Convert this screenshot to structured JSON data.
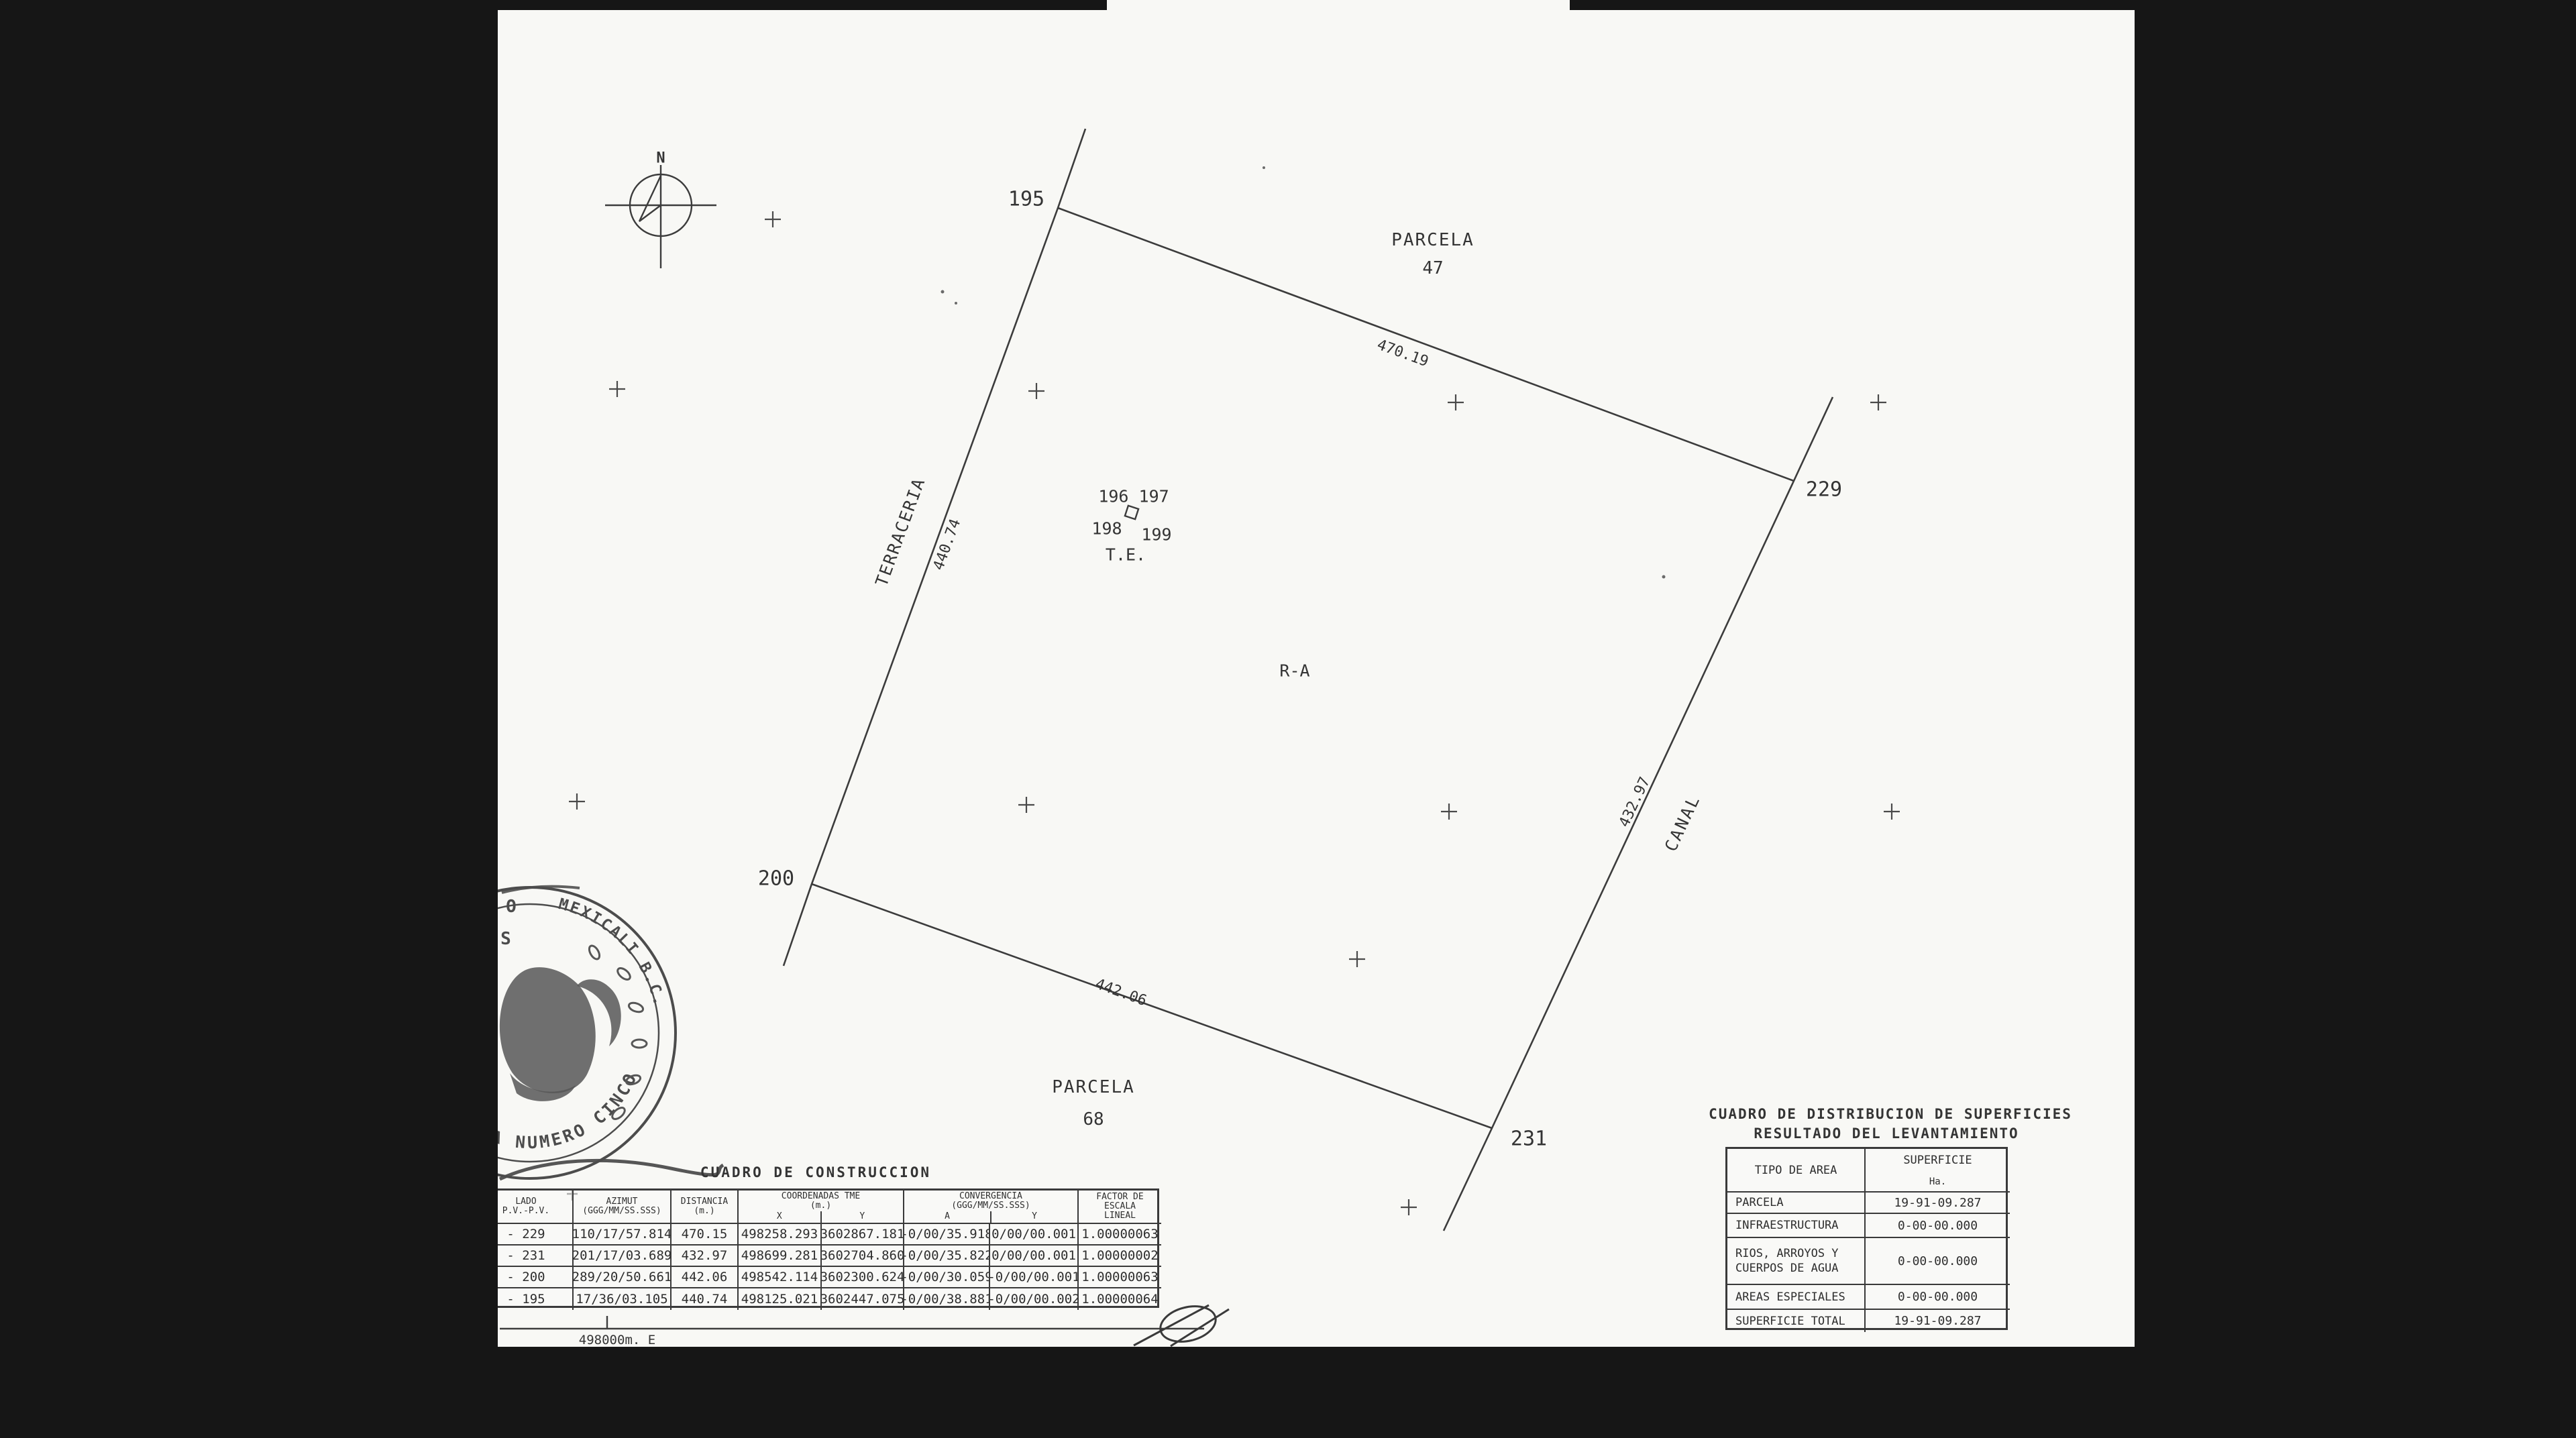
{
  "colors": {
    "paper": "#f8f8f5",
    "ink": "#2e2e2e",
    "bar": "#161616"
  },
  "map": {
    "north_label": "N",
    "vertices": {
      "v195": "195",
      "v229": "229",
      "v231": "231",
      "v200": "200"
    },
    "parcel_top": {
      "word": "PARCELA",
      "number": "47"
    },
    "parcel_bottom": {
      "word": "PARCELA",
      "number": "68"
    },
    "interior": {
      "points_row1": "196 197",
      "point_198": "198",
      "point_199": "199",
      "te": "T.E.",
      "ra": "R-A"
    },
    "edges": {
      "top_length": "470.19",
      "bottom_length": "442.06",
      "left_length": "440.74",
      "right_length": "432.97",
      "left_name": "TERRACERIA",
      "right_name": "CANAL"
    },
    "grid_label": "498000m. E"
  },
  "construction_table": {
    "title": "CUADRO DE CONSTRUCCION",
    "headers": {
      "lado": "LADO",
      "pv": "P.V.-P.V.",
      "azimut": "AZIMUT",
      "azimut_unit": "(GGG/MM/SS.SSS)",
      "distancia": "DISTANCIA",
      "distancia_unit": "(m.)",
      "coordenadas": "COORDENADAS TME",
      "coordenadas_unit": "(m.)",
      "x": "X",
      "y": "Y",
      "convergencia": "CONVERGENCIA",
      "convergencia_unit": "(GGG/MM/SS.SSS)",
      "conv_a": "A",
      "conv_y": "Y",
      "factor1": "FACTOR DE",
      "factor2": "ESCALA",
      "factor3": "LINEAL",
      "dagger": "+"
    },
    "rows": [
      {
        "pv": "- 229",
        "azimut": "110/17/57.814",
        "dist": "470.15",
        "x": "498258.293",
        "y": "3602867.181",
        "conv_a": "-0/00/35.918",
        "conv_y": "0/00/00.001",
        "factor": "1.00000063"
      },
      {
        "pv": "- 231",
        "azimut": "201/17/03.689",
        "dist": "432.97",
        "x": "498699.281",
        "y": "3602704.860",
        "conv_a": "-0/00/35.822",
        "conv_y": "0/00/00.001",
        "factor": "1.00000002"
      },
      {
        "pv": "- 200",
        "azimut": "289/20/50.661",
        "dist": "442.06",
        "x": "498542.114",
        "y": "3602300.624",
        "conv_a": "-0/00/30.059",
        "conv_y": "-0/00/00.001",
        "factor": "1.00000063"
      },
      {
        "pv": "- 195",
        "azimut": "17/36/03.105",
        "dist": "440.74",
        "x": "498125.021",
        "y": "3602447.075",
        "conv_a": "-0/00/38.881",
        "conv_y": "-0/00/00.002",
        "factor": "1.00000064"
      }
    ]
  },
  "distribution_table": {
    "title1": "CUADRO DE DISTRIBUCION DE SUPERFICIES",
    "title2": "RESULTADO DEL LEVANTAMIENTO",
    "col_tipo": "TIPO DE AREA",
    "col_sup1": "SUPERFICIE",
    "col_sup2": "Ha.",
    "rows": [
      {
        "tipo": "PARCELA",
        "tipo2": "",
        "sup": "19-91-09.287"
      },
      {
        "tipo": "INFRAESTRUCTURA",
        "tipo2": "",
        "sup": "0-00-00.000"
      },
      {
        "tipo": "RIOS, ARROYOS Y",
        "tipo2": "CUERPOS DE AGUA",
        "sup": "0-00-00.000"
      },
      {
        "tipo": "AREAS ESPECIALES",
        "tipo2": "",
        "sup": "0-00-00.000"
      },
      {
        "tipo": "SUPERFICIE TOTAL",
        "tipo2": "",
        "sup": "19-91-09.287"
      }
    ]
  },
  "seal": {
    "arc_top": "MEXICALI B.C.",
    "arc_bottom": "NOTARIA NUMERO CINCO",
    "fragment_o": "O",
    "fragment_s": "S"
  }
}
